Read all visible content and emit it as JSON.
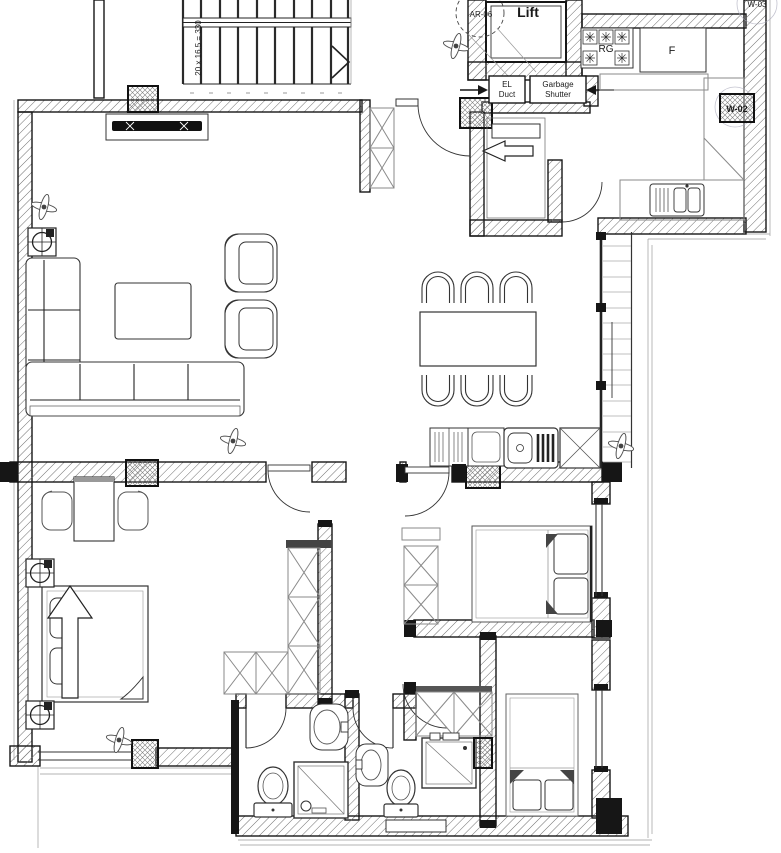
{
  "plan": {
    "labels": {
      "lift": "Lift",
      "ar_tag": "AR-06",
      "el_duct_l1": "EL",
      "el_duct_l2": "Duct",
      "garbage_l1": "Garbage",
      "garbage_l2": "Shutter",
      "range_tag": "RG",
      "fridge_tag": "F",
      "window_tag": "W-02",
      "window_tag_top": "W-03",
      "stair_note": "20 x 16.5 = 330"
    },
    "colors": {
      "ink": "#161616",
      "hatch": "#6f6f6f",
      "light_furniture": "#8a8a8a",
      "paper": "#ffffff"
    }
  }
}
